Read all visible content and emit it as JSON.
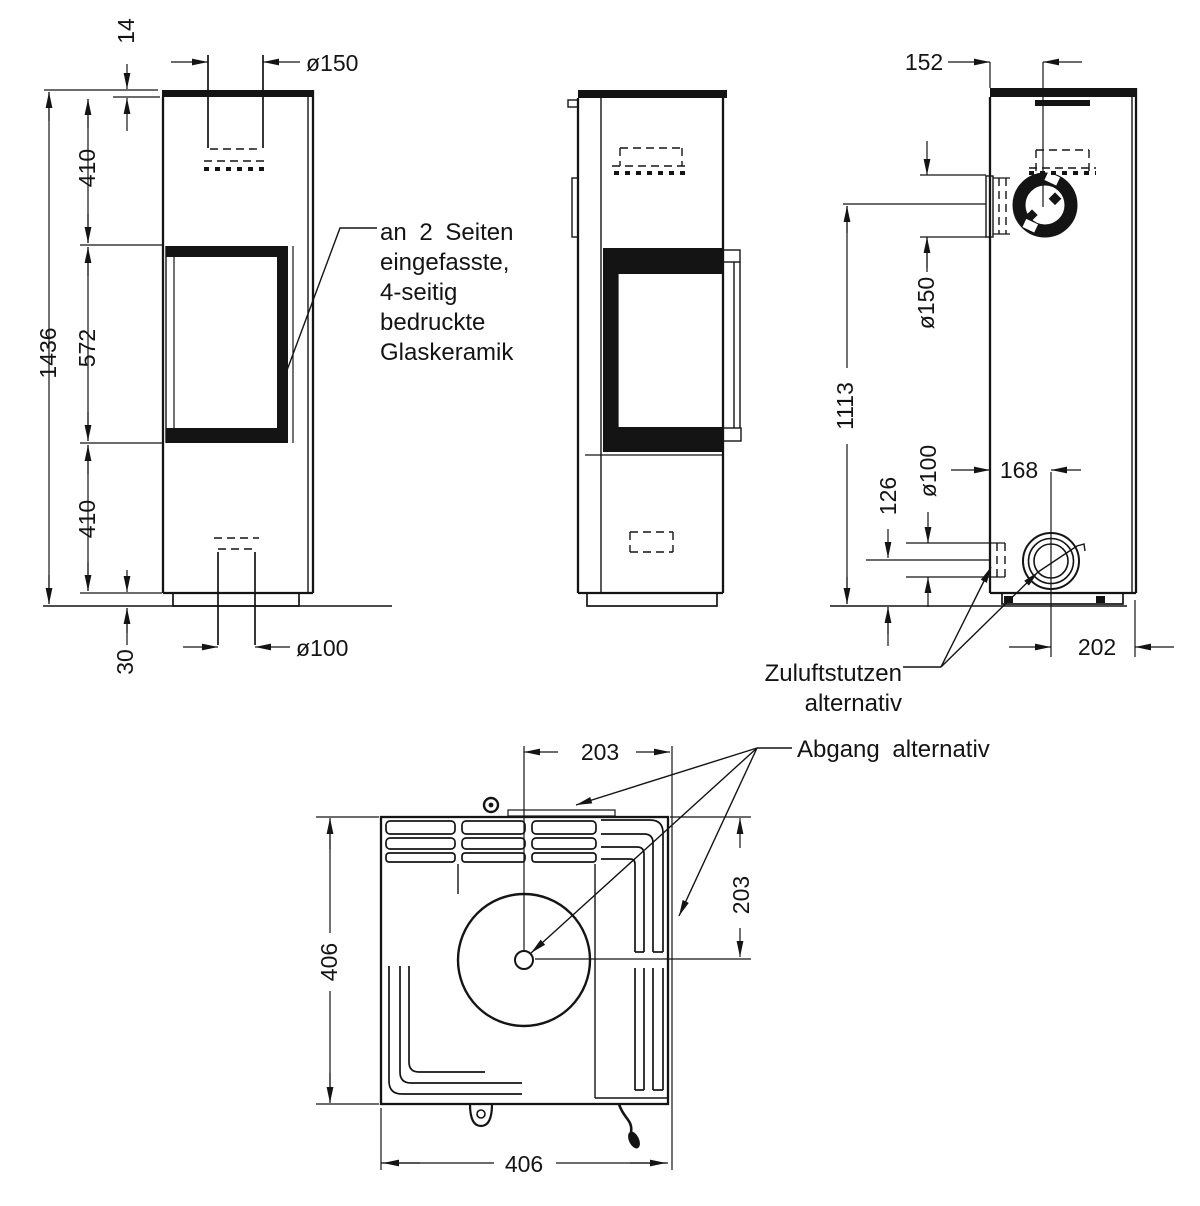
{
  "front_view": {
    "dims": {
      "plate_thickness": "14",
      "upper_section": "410",
      "glass_section": "572",
      "lower_section": "410",
      "total_height": "1436",
      "plinth_height": "30",
      "flue_diameter": "ø150",
      "air_inlet_diameter": "ø100"
    },
    "glass_note": [
      "an 2 Seiten",
      "eingefasste,",
      "4-seitig",
      "bedruckte",
      "Glaskeramik"
    ]
  },
  "rear_view": {
    "dims": {
      "flue_center_offset": "152",
      "side_flue_diameter": "ø150",
      "flue_center_height": "1113",
      "air_center_height": "126",
      "air_diameter": "ø100",
      "air_center_offset": "168",
      "air_depth_offset": "202"
    },
    "air_note": [
      "Zuluftstutzen",
      "alternativ"
    ]
  },
  "top_view": {
    "dims": {
      "flue_offset_x": "203",
      "flue_offset_y": "203",
      "width": "406",
      "depth": "406"
    },
    "flue_note": "Abgang alternativ"
  }
}
